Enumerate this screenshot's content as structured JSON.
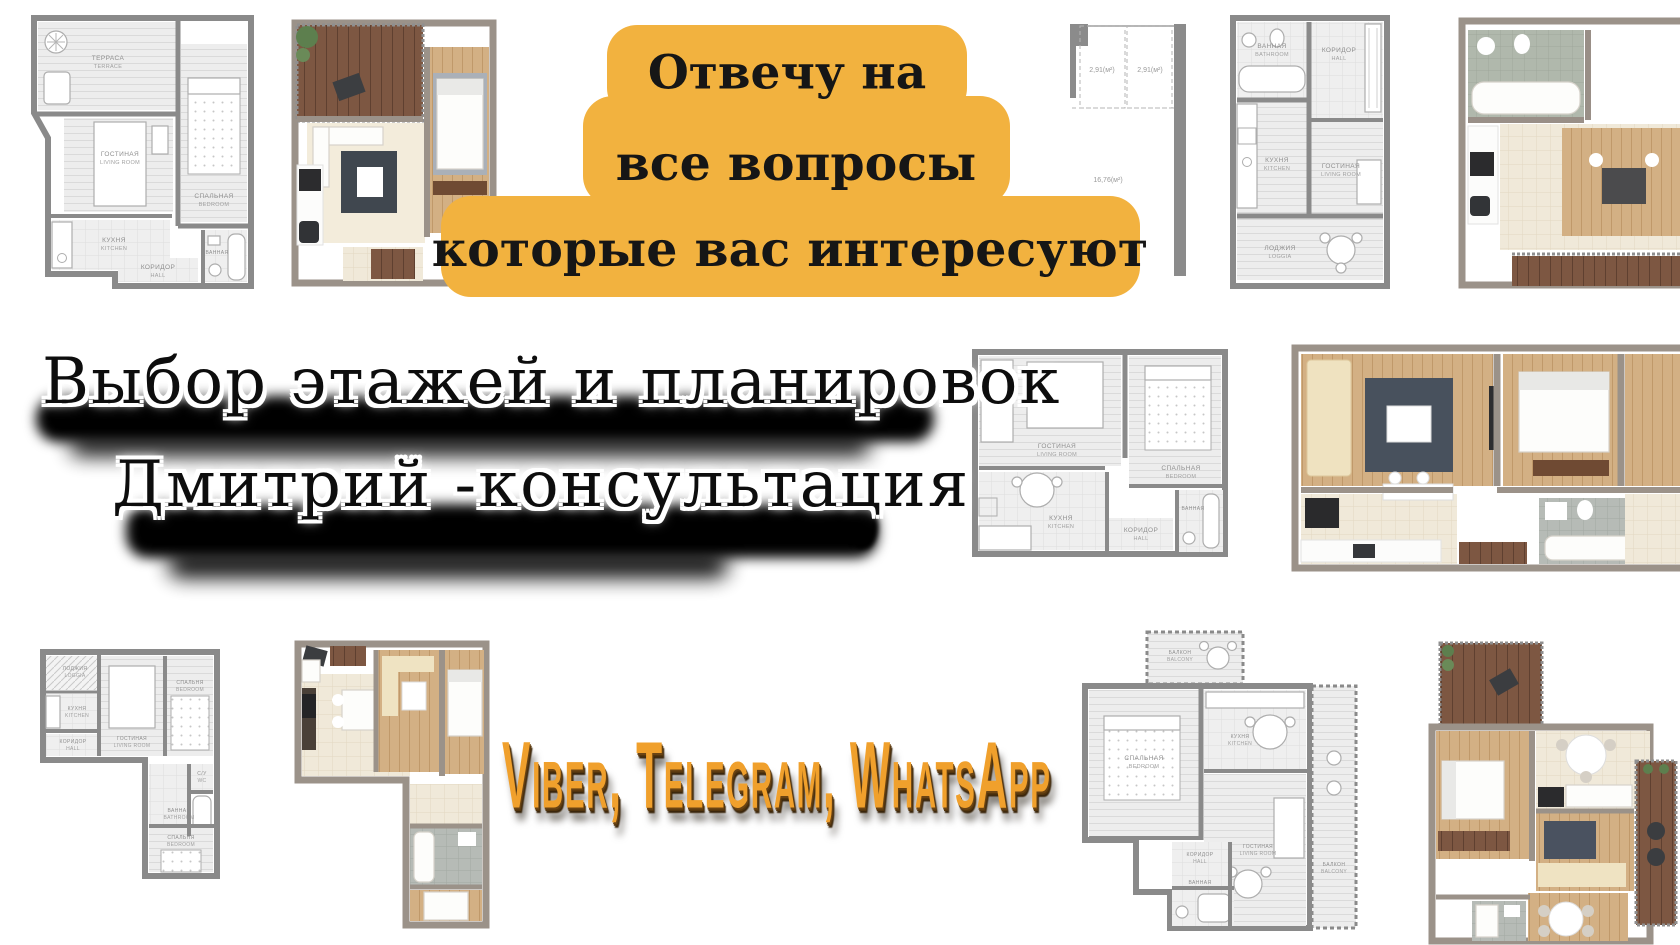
{
  "banner": {
    "lines": [
      "Отвечу на",
      "все вопросы",
      "которые вас интересуют"
    ],
    "bg_color": "#f2b23f",
    "text_color": "#161616"
  },
  "headline": {
    "line1": "Выбор этажей и планировок",
    "line2": "Дмитрий -консультация"
  },
  "messengers": {
    "label": "Viber, Telegram, WhatsApp",
    "color": "#f0a02c"
  },
  "plans": {
    "top_left": {
      "rooms": {
        "terrace": {
          "ru": "ТЕРРАСА",
          "en": "TERRACE"
        },
        "living": {
          "ru": "ГОСТИНАЯ",
          "en": "LIVING ROOM"
        },
        "bedroom": {
          "ru": "СПАЛЬНАЯ",
          "en": "BEDROOM"
        },
        "kitchen": {
          "ru": "КУХНЯ",
          "en": "KITCHEN"
        },
        "hall": {
          "ru": "КОРИДОР",
          "en": "HALL"
        },
        "bath": {
          "ru": "ВАННАЯ",
          "en": "BATHROOM"
        }
      }
    },
    "top_sketch": {
      "areas": [
        "2,91(м²)",
        "2,91(м²)",
        "16,76(м²)"
      ]
    },
    "top_studio": {
      "rooms": {
        "bath": {
          "ru": "ВАННАЯ",
          "en": "BATHROOM"
        },
        "hall": {
          "ru": "КОРИДОР",
          "en": "HALL"
        },
        "kitchen": {
          "ru": "КУХНЯ",
          "en": "KITCHEN"
        },
        "living": {
          "ru": "ГОСТИНАЯ",
          "en": "LIVING ROOM"
        },
        "loggia": {
          "ru": "ЛОДЖИЯ",
          "en": "LOGGIA"
        }
      }
    },
    "mid_tworoom": {
      "rooms": {
        "living": {
          "ru": "ГОСТИНАЯ",
          "en": "LIVING ROOM"
        },
        "bedroom": {
          "ru": "СПАЛЬНАЯ",
          "en": "BEDROOM"
        },
        "kitchen": {
          "ru": "КУХНЯ",
          "en": "KITCHEN"
        },
        "hall": {
          "ru": "КОРИДОР",
          "en": "HALL"
        },
        "bath": {
          "ru": "ВАННАЯ",
          "en": "BATHROOM"
        }
      }
    },
    "bottom_l": {
      "rooms": {
        "loggia": {
          "ru": "ЛОДЖИЯ",
          "en": "LOGGIA"
        },
        "kitchen": {
          "ru": "КУХНЯ",
          "en": "KITCHEN"
        },
        "living": {
          "ru": "ГОСТИНАЯ",
          "en": "LIVING ROOM"
        },
        "bedroom": {
          "ru": "СПАЛЬНЯ",
          "en": "BEDROOM"
        },
        "hall": {
          "ru": "КОРИДОР",
          "en": "HALL"
        },
        "wc": {
          "ru": "С/У",
          "en": "WC"
        },
        "bath": {
          "ru": "ВАННАЯ",
          "en": "BATHROOM"
        },
        "bedroom2": {
          "ru": "СПАЛЬНЯ",
          "en": "BEDROOM"
        }
      }
    },
    "bottom_balcony": {
      "rooms": {
        "balcony_top": {
          "ru": "БАЛКОН",
          "en": "BALCONY"
        },
        "bedroom": {
          "ru": "СПАЛЬНАЯ",
          "en": "BEDROOM"
        },
        "kitchen": {
          "ru": "КУХНЯ",
          "en": "KITCHEN"
        },
        "living": {
          "ru": "ГОСТИНАЯ",
          "en": "LIVING ROOM"
        },
        "hall": {
          "ru": "КОРИДОР",
          "en": "HALL"
        },
        "bath": {
          "ru": "ВАННАЯ",
          "en": "BATHROOM"
        },
        "balcony_right": {
          "ru": "БАЛКОН",
          "en": "BALCONY"
        }
      }
    }
  }
}
